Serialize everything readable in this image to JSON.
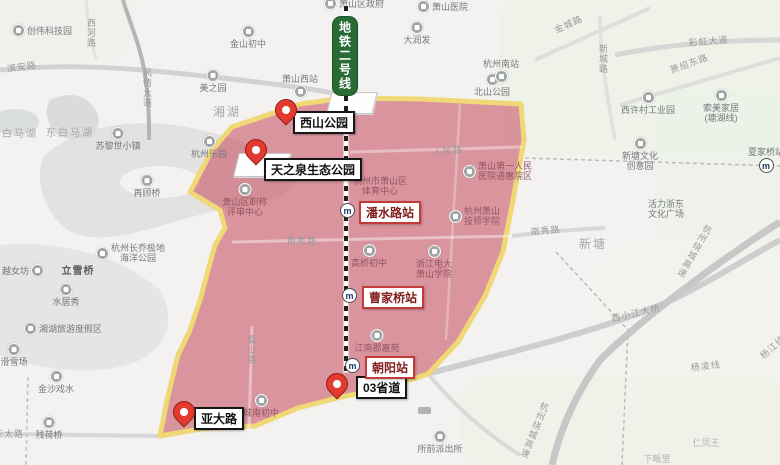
{
  "colors": {
    "polygon_fill": "#c84f62",
    "polygon_border": "#f1d876",
    "metro_badge_bg": "#276b35",
    "pin_red": "#e23a2e",
    "station_border_red": "#c23b3b",
    "label_border_black": "#161616"
  },
  "metro": {
    "badge_text": "地铁二号线",
    "logo_glyph": "m"
  },
  "pins": [
    {
      "id": "xishan-park",
      "label": "西山公园",
      "pin_x": 286,
      "pin_y": 126,
      "box_x": 293,
      "box_y": 111
    },
    {
      "id": "tianzhiquan-eco-park",
      "label": "天之泉生态公园",
      "pin_x": 256,
      "pin_y": 166,
      "box_x": 264,
      "box_y": 158
    },
    {
      "id": "yada-road",
      "label": "亚大路",
      "pin_x": 184,
      "pin_y": 428,
      "box_x": 194,
      "box_y": 407
    },
    {
      "id": "provincial-road-03",
      "label": "03省道",
      "pin_x": 337,
      "pin_y": 400,
      "box_x": 356,
      "box_y": 376
    }
  ],
  "stations": [
    {
      "label": "潘水路站",
      "icon_x": 348,
      "icon_y": 211,
      "box_x": 359,
      "box_y": 201
    },
    {
      "label": "曹家桥站",
      "icon_x": 350,
      "icon_y": 296,
      "box_x": 362,
      "box_y": 286
    },
    {
      "label": "朝阳站",
      "icon_x": 353,
      "icon_y": 366,
      "box_x": 365,
      "box_y": 356
    }
  ],
  "pois": [
    {
      "n": "chuangwei-tech-park",
      "t": "创伟科技园",
      "x": 12,
      "y": 24,
      "icon": "left"
    },
    {
      "n": "jinshan-middle-school",
      "t": "金山初中",
      "x": 248,
      "y": 25,
      "icon": "above"
    },
    {
      "n": "meizhiyuan",
      "t": "美之园",
      "x": 213,
      "y": 69,
      "icon": "above"
    },
    {
      "n": "xiaoshan-west-station",
      "t": "萧山西站",
      "x": 300,
      "y": 74,
      "icon": "below"
    },
    {
      "n": "xiaoshan-district-gov",
      "t": "萧山区政府",
      "x": 324,
      "y": -3,
      "icon": "left"
    },
    {
      "n": "xiaoshan-hospital",
      "t": "萧山医院",
      "x": 417,
      "y": 0,
      "icon": "left"
    },
    {
      "n": "darunfa",
      "t": "大润发",
      "x": 417,
      "y": 21,
      "icon": "above"
    },
    {
      "n": "beishan-park",
      "t": "北山公园",
      "x": 492,
      "y": 73,
      "icon": "above"
    },
    {
      "n": "hangzhou-south-station",
      "t": "杭州南站",
      "x": 501,
      "y": 59,
      "icon": "below"
    },
    {
      "n": "xixucun-industrial-park",
      "t": "西许村工业园",
      "x": 648,
      "y": 91,
      "icon": "above"
    },
    {
      "n": "suomei-home",
      "t": "索美家居",
      "t2": "(塘湖线)",
      "x": 721,
      "y": 89,
      "icon": "above"
    },
    {
      "n": "xintang-culture-creative-park",
      "t": "新塘文化",
      "t2": "创意园",
      "x": 640,
      "y": 137,
      "icon": "above"
    },
    {
      "n": "xiajiaqiao-station",
      "t": "夏家桥站",
      "x": 766,
      "y": 147,
      "icon": "below",
      "metro": true
    },
    {
      "n": "huoli-zhedong-plaza",
      "t": "活力浙东",
      "t2": "文化广场",
      "x": 666,
      "y": 199
    },
    {
      "n": "changqiao-polar-ocean-park",
      "t": "杭州长乔极地",
      "t2": "海洋公园",
      "x": 96,
      "y": 243,
      "icon": "left"
    },
    {
      "n": "zurich-town",
      "t": "苏黎世小镇",
      "x": 118,
      "y": 127,
      "icon": "above"
    },
    {
      "n": "hangzhou-paradise",
      "t": "杭州乐园",
      "x": 209,
      "y": 135,
      "icon": "above"
    },
    {
      "n": "zaiguqiao",
      "t": "再顾桥",
      "x": 147,
      "y": 174,
      "icon": "above"
    },
    {
      "n": "yuenvfang",
      "t": "越女坊",
      "x": 2,
      "y": 264,
      "icon": "right"
    },
    {
      "n": "lixueqiao",
      "t": "立雪桥",
      "x": 78,
      "y": 267,
      "cls": "dark"
    },
    {
      "n": "shuijuxiu",
      "t": "水居秀",
      "x": 66,
      "y": 283,
      "icon": "above"
    },
    {
      "n": "xianghu-resort",
      "t": "湘湖旅游度假区",
      "x": 24,
      "y": 322,
      "icon": "left"
    },
    {
      "n": "ski-field",
      "t": "滑雪场",
      "x": 14,
      "y": 343,
      "icon": "above"
    },
    {
      "n": "jinsha-xishui",
      "t": "金沙戏水",
      "x": 56,
      "y": 370,
      "icon": "above"
    },
    {
      "n": "canheqiao",
      "t": "残荷桥",
      "x": 49,
      "y": 416,
      "icon": "above"
    },
    {
      "n": "chengnan-middle-school",
      "t": "城南初中",
      "x": 261,
      "y": 394,
      "icon": "above",
      "cls": "muted"
    },
    {
      "n": "suoqian-police-station",
      "t": "所前派出所",
      "x": 440,
      "y": 430,
      "icon": "above"
    },
    {
      "n": "xiaoshan-review-center",
      "t": "萧山区职称",
      "t2": "评审中心",
      "x": 245,
      "y": 183,
      "icon": "above",
      "cls": "muted"
    },
    {
      "n": "xiaoshan-sports-center",
      "t": "杭州市萧山区",
      "t2": "体育中心",
      "x": 380,
      "y": 176,
      "cls": "muted"
    },
    {
      "n": "first-peoples-hospital",
      "t": "萧山第一人民",
      "t2": "医院通惠院区",
      "x": 463,
      "y": 161,
      "icon": "left",
      "cls": "muted"
    },
    {
      "n": "jishi-college",
      "t": "杭州萧山",
      "t2": "技师学院",
      "x": 449,
      "y": 206,
      "icon": "left",
      "cls": "muted"
    },
    {
      "n": "dianda-college",
      "t": "浙江电大",
      "t2": "萧山学院",
      "x": 434,
      "y": 245,
      "icon": "above",
      "cls": "muted"
    },
    {
      "n": "gaoqiao-middle-school",
      "t": "高桥初中",
      "x": 369,
      "y": 244,
      "icon": "above",
      "cls": "muted"
    },
    {
      "n": "jiangnanjun-jiayuan",
      "t": "江南郡嘉苑",
      "x": 377,
      "y": 329,
      "icon": "above",
      "cls": "muted"
    },
    {
      "n": "renfengwang",
      "t": "仁凤王",
      "x": 706,
      "y": 438,
      "cls": "faint"
    },
    {
      "n": "xiafanli",
      "t": "下畈里",
      "x": 657,
      "y": 454,
      "cls": "faint"
    }
  ],
  "roads": [
    {
      "t": "西河路",
      "x": 85,
      "y": 18,
      "vert": true
    },
    {
      "t": "风情大道",
      "x": 141,
      "y": 68,
      "vert": true
    },
    {
      "t": "滨安路",
      "x": 6,
      "y": 62,
      "rot": -8
    },
    {
      "t": "金城路",
      "x": 552,
      "y": 24,
      "rot": -24
    },
    {
      "t": "彩虹大道",
      "x": 688,
      "y": 36,
      "rot": -5
    },
    {
      "t": "新城路",
      "x": 597,
      "y": 44,
      "vert": true
    },
    {
      "t": "萧绍东路",
      "x": 668,
      "y": 64,
      "rot": -20
    },
    {
      "t": "人民路",
      "x": 432,
      "y": 146,
      "rot": -7
    },
    {
      "t": "南秀路",
      "x": 287,
      "y": 234
    },
    {
      "t": "南秀路",
      "x": 530,
      "y": 225,
      "rot": -5
    },
    {
      "t": "蜀山路",
      "x": 245,
      "y": 335,
      "vert": true
    },
    {
      "t": "亚太路",
      "x": -6,
      "y": 427
    },
    {
      "t": "西小江大桥",
      "x": 610,
      "y": 312,
      "rot": -13
    },
    {
      "t": "杨凌线",
      "x": 690,
      "y": 361,
      "rot": -7
    },
    {
      "t": "杭州绕城高速",
      "x": 540,
      "y": 400,
      "vert": true,
      "rot": 22
    },
    {
      "t": "杭州绕城高速",
      "x": 704,
      "y": 222,
      "vert": true,
      "rot": 30
    },
    {
      "t": "杨江线",
      "x": 757,
      "y": 352,
      "rot": -42
    }
  ],
  "areas": [
    {
      "t": "湘湖",
      "x": 227,
      "y": 103,
      "s": 12
    },
    {
      "t": "白马湖",
      "x": 20,
      "y": 125,
      "s": 10
    },
    {
      "t": "东白马湖",
      "x": 70,
      "y": 124,
      "s": 10
    },
    {
      "t": "新塘",
      "x": 593,
      "y": 235,
      "s": 12
    }
  ]
}
